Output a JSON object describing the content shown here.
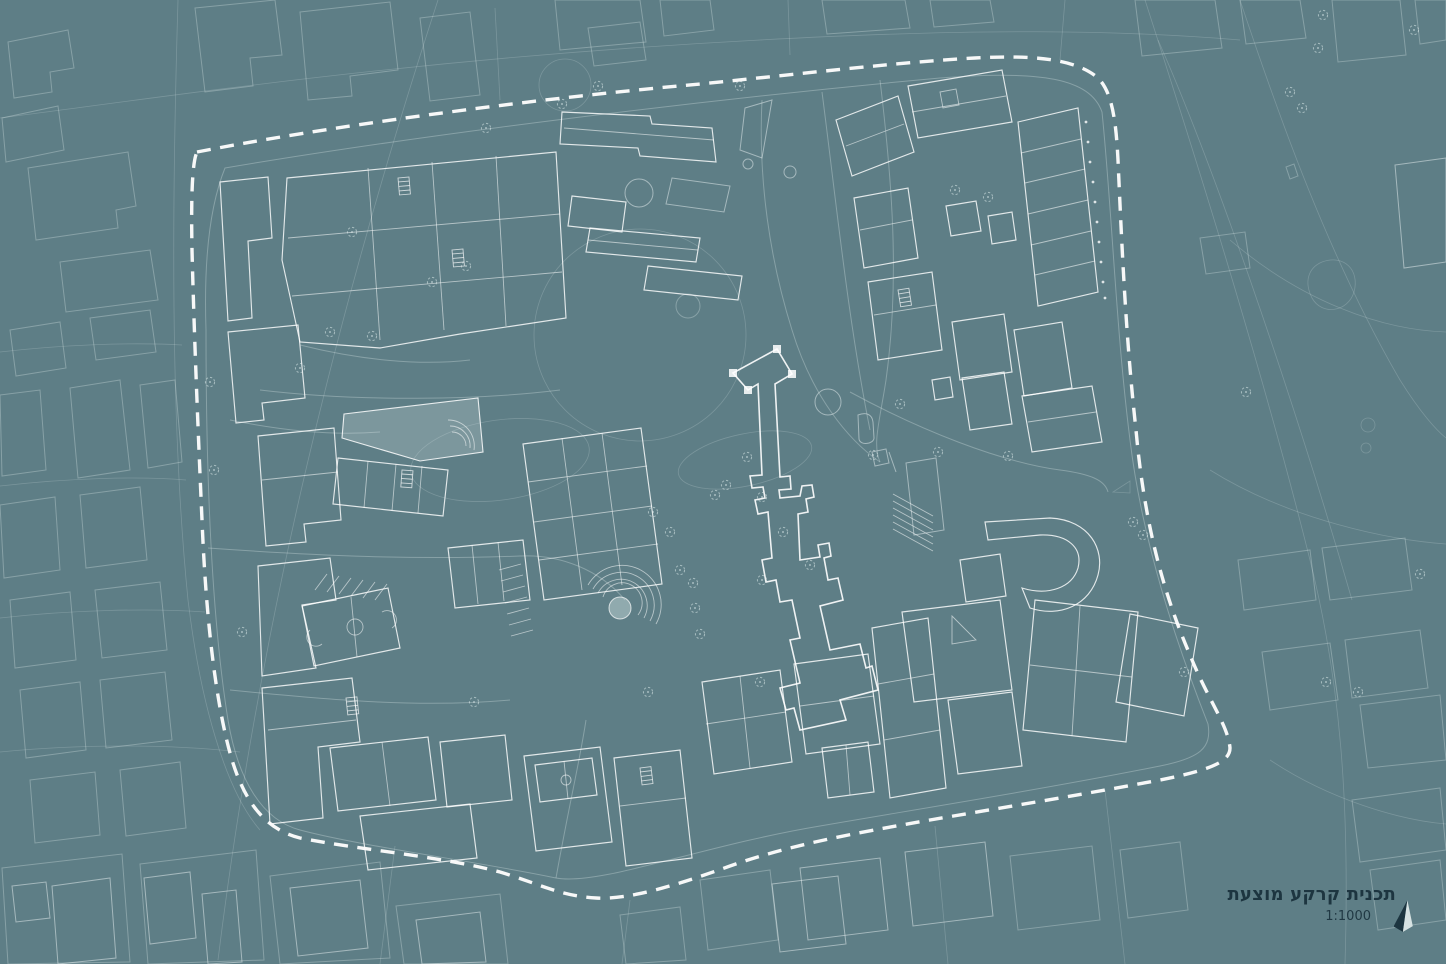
{
  "title_block": {
    "title": "תכנית קרקע מוצעת",
    "scale": "1:1000"
  },
  "colors": {
    "background": "#5e7e86",
    "linework": "#ffffff",
    "boundary_dash": "#fdfdfd",
    "highlight_fill": "#e8f3f3",
    "title_text": "#1d3540"
  },
  "map": {
    "kind": "architectural site plan",
    "boundary_style": "white dashed loop around site",
    "north_arrow_icon": "compass-needle"
  }
}
